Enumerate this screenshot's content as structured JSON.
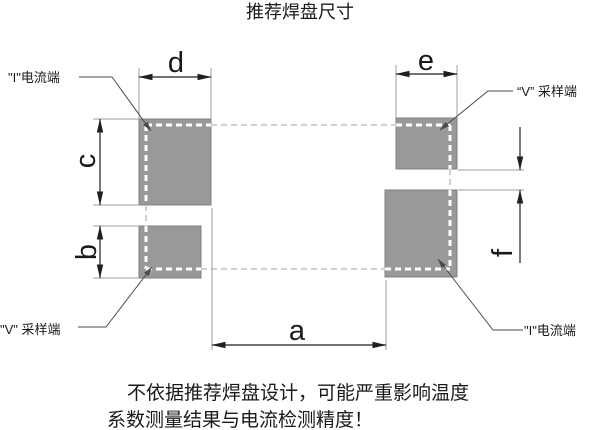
{
  "diagram": {
    "title": "推荐焊盘尺寸",
    "terminal_labels": {
      "top_left": "\"I\"电流端",
      "top_right": "“V” 采样端",
      "bottom_left": "\"V\" 采样端",
      "bottom_right": "\"I\"电流端"
    },
    "dimension_labels": {
      "a": "a",
      "b": "b",
      "c": "c",
      "d": "d",
      "e": "e",
      "f": "f"
    },
    "warning": {
      "line1": "不依据推荐焊盘设计，可能严重影响温度",
      "line2": "系数测量结果与电流检测精度！"
    },
    "colors": {
      "background": "#ffffff",
      "text": "#1a1a1a",
      "pad_fill": "#97999b",
      "pad_border": "#7f8183",
      "dimension_line": "#1f1f1f",
      "extension_line": "#9c9c9c",
      "leader_line": "#4a4a4a",
      "component_outline_on_pad": "#ffffff",
      "component_outline_off_pad": "#cfcfcf"
    }
  }
}
